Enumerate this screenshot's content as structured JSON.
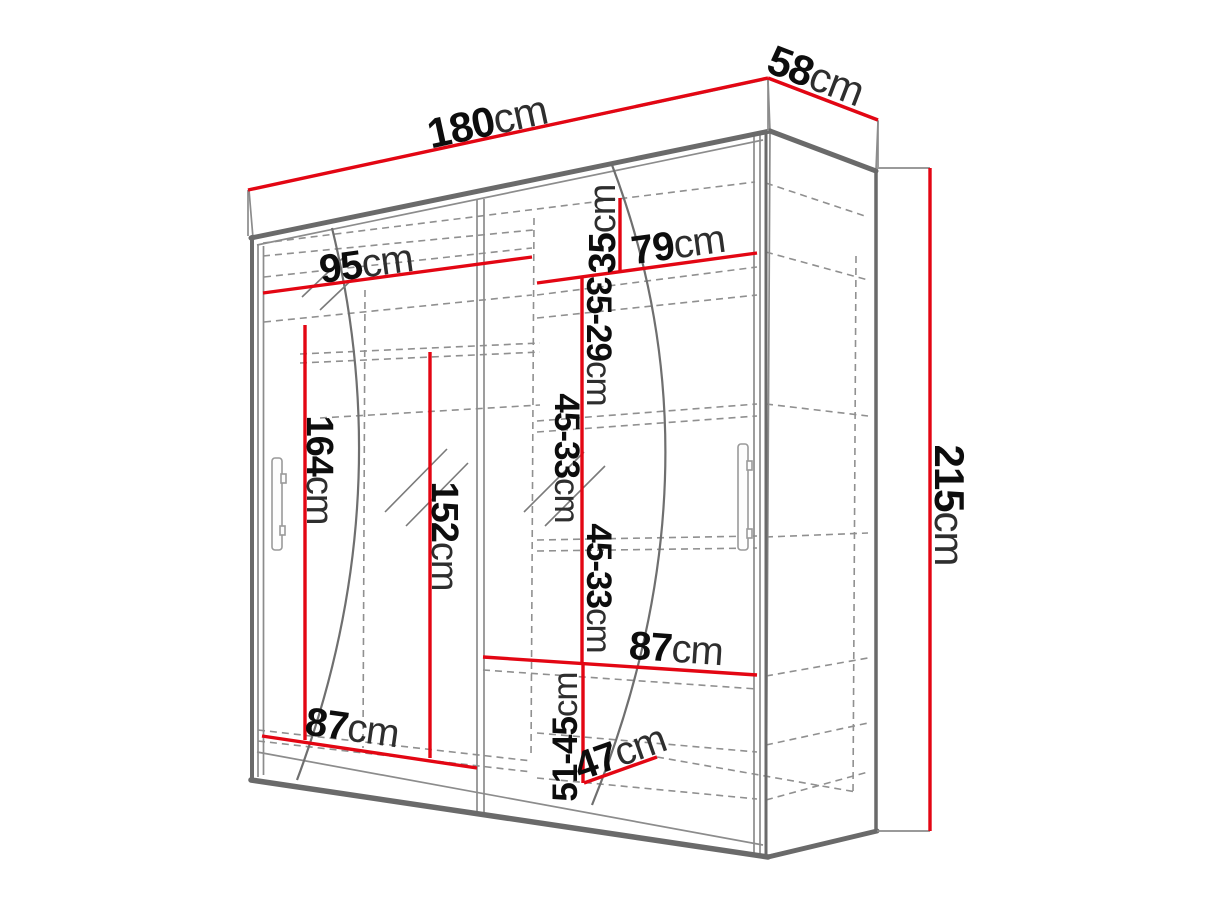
{
  "diagram": {
    "kind": "wardrobe-dimension-diagram",
    "unit": "cm",
    "dims": {
      "width": {
        "v": "180",
        "u": "cm"
      },
      "depth": {
        "v": "58",
        "u": "cm"
      },
      "height": {
        "v": "215",
        "u": "cm"
      },
      "left_width": {
        "v": "95",
        "u": "cm"
      },
      "right_width": {
        "v": "79",
        "u": "cm"
      },
      "top_gap": {
        "v": "35",
        "u": "cm"
      },
      "gap_35_29": {
        "v": "35-29",
        "u": "cm"
      },
      "gap_45_33_upper": {
        "v": "45-33",
        "u": "cm"
      },
      "gap_45_33_lower": {
        "v": "45-33",
        "u": "cm"
      },
      "gap_51_45": {
        "v": "51-45",
        "u": "cm"
      },
      "hanging_height": {
        "v": "164",
        "u": "cm"
      },
      "mid_height": {
        "v": "152",
        "u": "cm"
      },
      "shelf_width_mid": {
        "v": "87",
        "u": "cm"
      },
      "shelf_width_low": {
        "v": "87",
        "u": "cm"
      },
      "floor_depth": {
        "v": "47",
        "u": "cm"
      }
    },
    "colors": {
      "dimension_line": "#e30613",
      "outline": "#6a6a6a",
      "hidden_line": "#909090",
      "text": "#0d0d0d"
    }
  }
}
